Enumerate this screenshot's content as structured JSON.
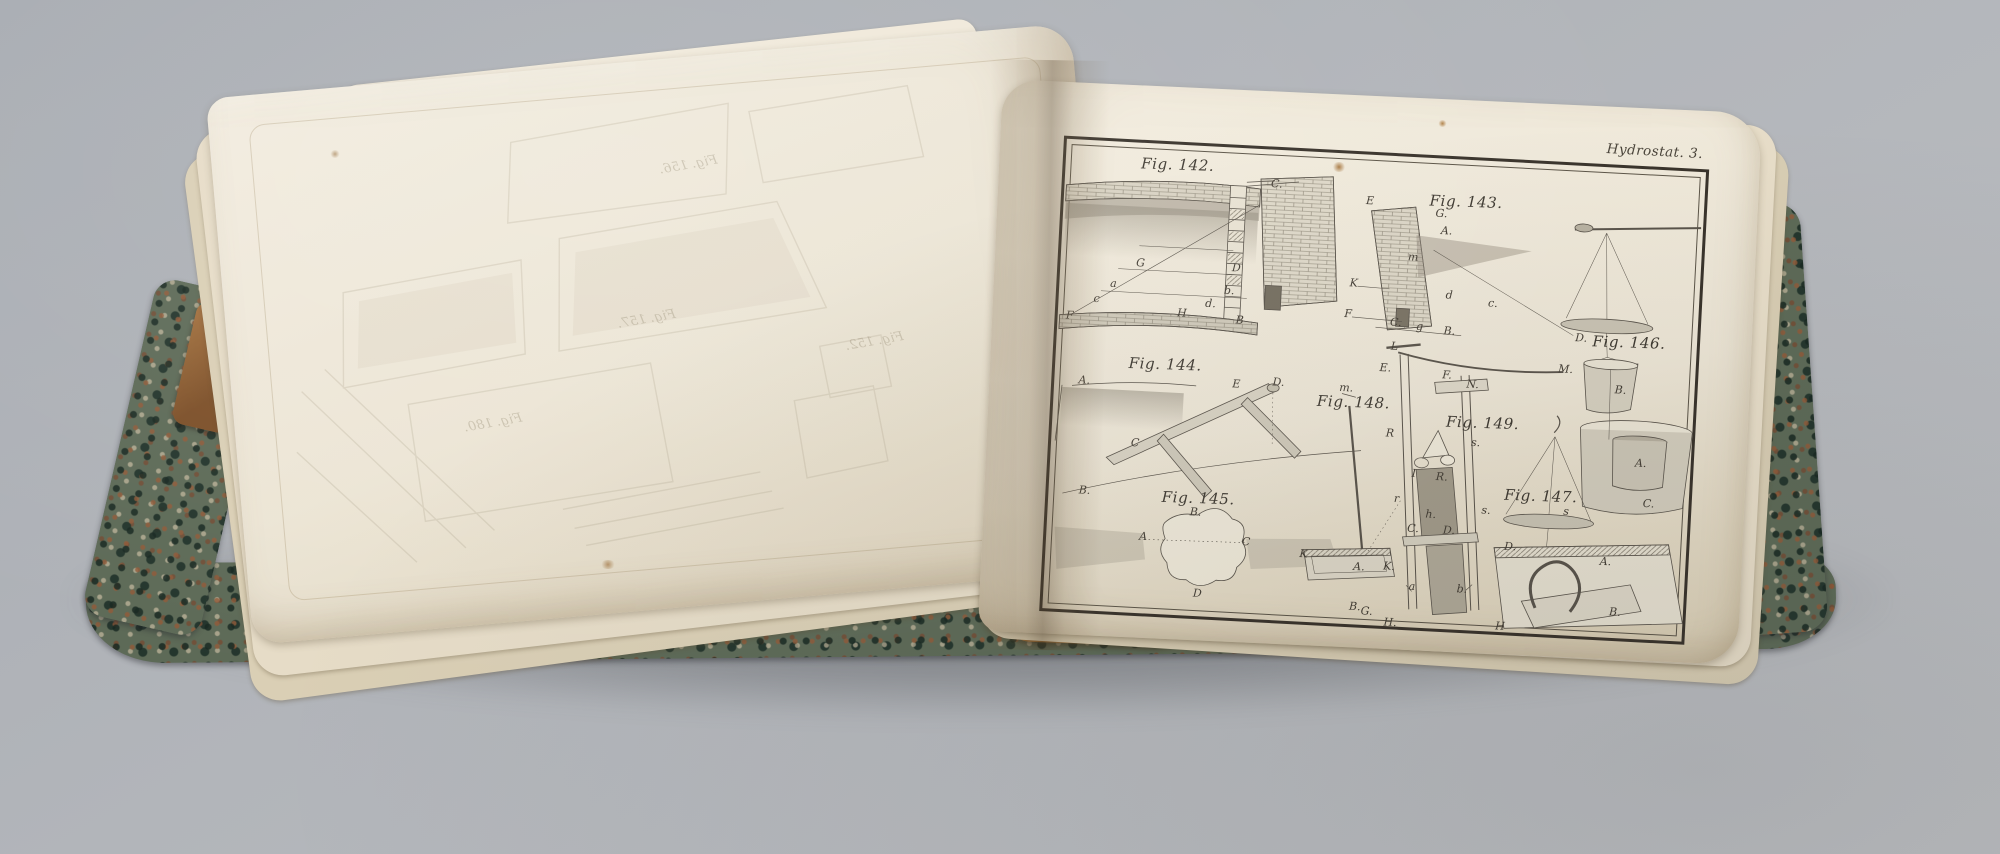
{
  "scene": {
    "type": "photograph of an open antique book with engraved hydrostatics plates",
    "background_color": "#b2b5ba",
    "page_color": "#ece5d5",
    "ink_color": "#4a443a",
    "marbled_cover_color": "#5d6a57",
    "leather_color": "#a5723f"
  },
  "book": {
    "plate": {
      "header": "Hydrostat. 3.",
      "annotations": [
        {
          "text": "Fig. 142.",
          "x": 112,
          "y": 20,
          "cls": "caption"
        },
        {
          "text": "Fig. 143.",
          "x": 402,
          "y": 42,
          "cls": "caption"
        },
        {
          "text": "Fig. 144.",
          "x": 110,
          "y": 220,
          "cls": "caption"
        },
        {
          "text": "Fig. 145.",
          "x": 150,
          "y": 352,
          "cls": "caption"
        },
        {
          "text": "Fig. 146.",
          "x": 572,
          "y": 174,
          "cls": "caption"
        },
        {
          "text": "Fig. 147.",
          "x": 492,
          "y": 332,
          "cls": "caption"
        },
        {
          "text": "Fig. 148.",
          "x": 300,
          "y": 248,
          "cls": "caption"
        },
        {
          "text": "Fig. 149.",
          "x": 430,
          "y": 262,
          "cls": "caption"
        },
        {
          "text": "C.",
          "x": 212,
          "y": 34,
          "cls": "letter"
        },
        {
          "text": "G",
          "x": 80,
          "y": 120,
          "cls": "letter"
        },
        {
          "text": "D",
          "x": 176,
          "y": 120,
          "cls": "letter"
        },
        {
          "text": "a",
          "x": 54,
          "y": 142,
          "cls": "letter"
        },
        {
          "text": "b.",
          "x": 170,
          "y": 143,
          "cls": "letter"
        },
        {
          "text": "c",
          "x": 38,
          "y": 158,
          "cls": "letter"
        },
        {
          "text": "d.",
          "x": 152,
          "y": 157,
          "cls": "letter"
        },
        {
          "text": "F",
          "x": 12,
          "y": 176,
          "cls": "letter"
        },
        {
          "text": "H",
          "x": 124,
          "y": 168,
          "cls": "letter"
        },
        {
          "text": "B",
          "x": 182,
          "y": 172,
          "cls": "letter"
        },
        {
          "text": "E",
          "x": 306,
          "y": 46,
          "cls": "letter"
        },
        {
          "text": "G.",
          "x": 378,
          "y": 55,
          "cls": "letter"
        },
        {
          "text": "A.",
          "x": 384,
          "y": 72,
          "cls": "letter"
        },
        {
          "text": "m",
          "x": 352,
          "y": 100,
          "cls": "letter"
        },
        {
          "text": "K",
          "x": 294,
          "y": 129,
          "cls": "letter"
        },
        {
          "text": "F",
          "x": 290,
          "y": 160,
          "cls": "letter"
        },
        {
          "text": "d",
          "x": 390,
          "y": 136,
          "cls": "letter"
        },
        {
          "text": "c.",
          "x": 434,
          "y": 142,
          "cls": "letter"
        },
        {
          "text": "C.",
          "x": 338,
          "y": 166,
          "cls": "letter"
        },
        {
          "text": "g",
          "x": 362,
          "y": 169,
          "cls": "letter"
        },
        {
          "text": "B.",
          "x": 392,
          "y": 172,
          "cls": "letter"
        },
        {
          "text": "D.",
          "x": 524,
          "y": 172,
          "cls": "letter"
        },
        {
          "text": "B.",
          "x": 566,
          "y": 222,
          "cls": "letter"
        },
        {
          "text": "A.",
          "x": 590,
          "y": 294,
          "cls": "letter"
        },
        {
          "text": "C.",
          "x": 600,
          "y": 334,
          "cls": "letter"
        },
        {
          "text": "s",
          "x": 518,
          "y": 346,
          "cls": "letter"
        },
        {
          "text": "D.",
          "x": 464,
          "y": 384,
          "cls": "letter"
        },
        {
          "text": "A.",
          "x": 560,
          "y": 394,
          "cls": "letter"
        },
        {
          "text": "B.",
          "x": 572,
          "y": 444,
          "cls": "letter"
        },
        {
          "text": "H",
          "x": 458,
          "y": 464,
          "cls": "letter"
        },
        {
          "text": "A.",
          "x": 30,
          "y": 240,
          "cls": "letter"
        },
        {
          "text": "E",
          "x": 182,
          "y": 236,
          "cls": "letter"
        },
        {
          "text": "D.",
          "x": 224,
          "y": 232,
          "cls": "letter"
        },
        {
          "text": "C",
          "x": 84,
          "y": 300,
          "cls": "letter"
        },
        {
          "text": "B.",
          "x": 36,
          "y": 350,
          "cls": "letter"
        },
        {
          "text": "B.",
          "x": 148,
          "y": 366,
          "cls": "letter"
        },
        {
          "text": "A",
          "x": 97,
          "y": 393,
          "cls": "letter"
        },
        {
          "text": "C",
          "x": 200,
          "y": 393,
          "cls": "letter"
        },
        {
          "text": "D",
          "x": 154,
          "y": 447,
          "cls": "letter"
        },
        {
          "text": "m.",
          "x": 292,
          "y": 234,
          "cls": "letter"
        },
        {
          "text": "K",
          "x": 258,
          "y": 402,
          "cls": "letter"
        },
        {
          "text": "A.",
          "x": 314,
          "y": 412,
          "cls": "letter"
        },
        {
          "text": "K.",
          "x": 344,
          "y": 410,
          "cls": "letter"
        },
        {
          "text": "G.",
          "x": 324,
          "y": 456,
          "cls": "letter"
        },
        {
          "text": "L",
          "x": 338,
          "y": 190,
          "cls": "letter"
        },
        {
          "text": "M.",
          "x": 510,
          "y": 204,
          "cls": "letter"
        },
        {
          "text": "E.",
          "x": 330,
          "y": 212,
          "cls": "letter"
        },
        {
          "text": "F.",
          "x": 392,
          "y": 216,
          "cls": "letter"
        },
        {
          "text": "N.",
          "x": 418,
          "y": 224,
          "cls": "letter"
        },
        {
          "text": "R",
          "x": 338,
          "y": 277,
          "cls": "letter"
        },
        {
          "text": "s.",
          "x": 424,
          "y": 282,
          "cls": "letter"
        },
        {
          "text": "I",
          "x": 364,
          "y": 316,
          "cls": "letter"
        },
        {
          "text": "R.",
          "x": 392,
          "y": 318,
          "cls": "letter"
        },
        {
          "text": "r",
          "x": 348,
          "y": 342,
          "cls": "letter"
        },
        {
          "text": "s.",
          "x": 438,
          "y": 349,
          "cls": "letter"
        },
        {
          "text": "h.",
          "x": 383,
          "y": 356,
          "cls": "letter"
        },
        {
          "text": "C.",
          "x": 366,
          "y": 371,
          "cls": "letter"
        },
        {
          "text": "D.",
          "x": 402,
          "y": 371,
          "cls": "letter"
        },
        {
          "text": "a",
          "x": 368,
          "y": 429,
          "cls": "letter"
        },
        {
          "text": "b.",
          "x": 418,
          "y": 429,
          "cls": "letter"
        },
        {
          "text": "B.",
          "x": 312,
          "y": 452,
          "cls": "letter"
        },
        {
          "text": "H.",
          "x": 348,
          "y": 466,
          "cls": "letter"
        }
      ]
    },
    "left_page": {
      "ghost_labels": [
        {
          "text": "Fig. 156.",
          "x": 475,
          "y": 108,
          "cls": "ghost"
        },
        {
          "text": "Fig. 157.",
          "x": 420,
          "y": 258,
          "cls": "ghost"
        },
        {
          "text": "Fig. 152.",
          "x": 645,
          "y": 300,
          "cls": "ghost"
        },
        {
          "text": "Fig. 180.",
          "x": 258,
          "y": 348,
          "cls": "ghost"
        }
      ]
    }
  }
}
